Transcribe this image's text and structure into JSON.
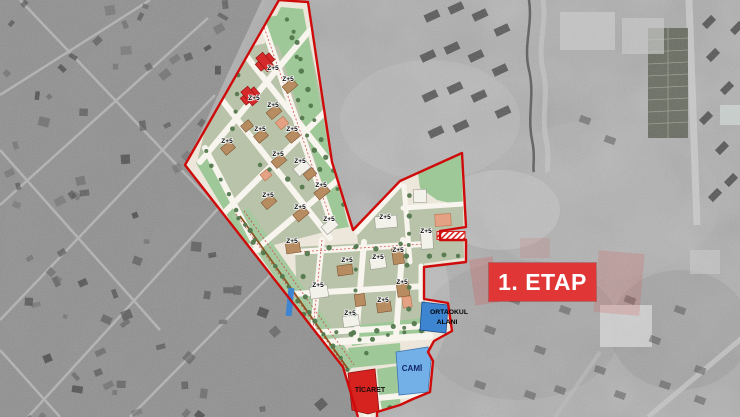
{
  "overlay": {
    "etap_label": "1. ETAP",
    "etap_bg": "#e13636",
    "etap_text_color": "#ffffff"
  },
  "plan": {
    "block_label": "Z+5",
    "block_label_count": 23,
    "zones": {
      "school_line1": "ORTAOKUL",
      "school_line2": "ALANI",
      "school_color": "#3d85d1",
      "mosque_label": "CAMİ",
      "mosque_color": "#74b0e8",
      "commerce_label": "TİCARET",
      "commerce_color": "#d7231f"
    },
    "colors": {
      "boundary_red": "#cf0a0a",
      "park_green": "#9fc898",
      "block_green": "#b9c3a9",
      "road_cream": "#ece7da",
      "street_white": "#f8f5ee",
      "building_tan": "#b78c60",
      "building_white": "#f2f1ea",
      "building_red": "#d62a2a",
      "tree_green": "#53784e"
    }
  }
}
